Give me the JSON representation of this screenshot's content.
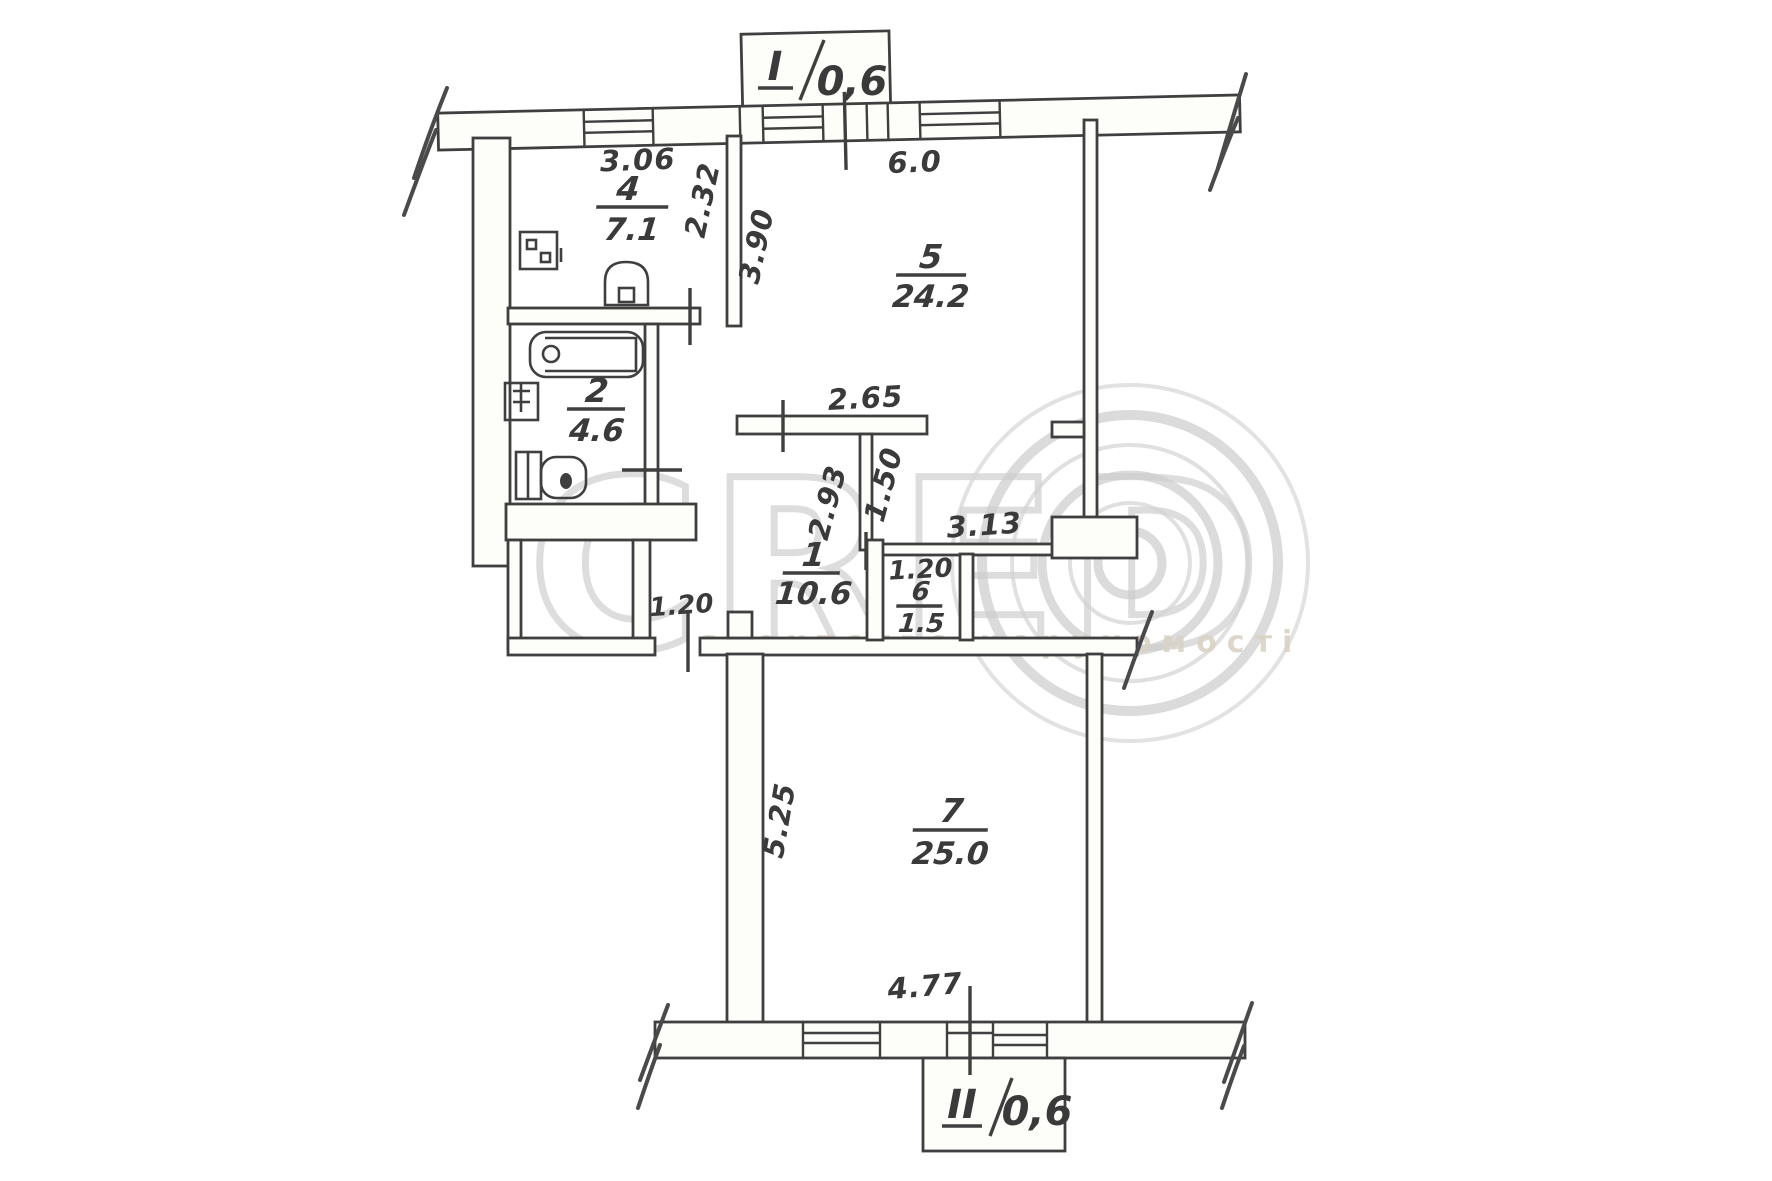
{
  "watermark": {
    "brand": "CRED",
    "agency": "агентство нерухомості"
  },
  "balconies": {
    "top": {
      "numeral": "I",
      "slash": "/",
      "area": "0,6"
    },
    "bottom": {
      "numeral": "II",
      "slash": "/",
      "area": "0,6"
    }
  },
  "rooms": [
    {
      "id": "kitchen",
      "number": "4",
      "area": "7.1"
    },
    {
      "id": "bathroom",
      "number": "2",
      "area": "4.6"
    },
    {
      "id": "living",
      "number": "5",
      "area": "24.2"
    },
    {
      "id": "hall",
      "number": "1",
      "area": "10.6"
    },
    {
      "id": "closet",
      "number": "6",
      "area": "1.5"
    },
    {
      "id": "bedroom",
      "number": "7",
      "area": "25.0"
    }
  ],
  "dimensions": {
    "kitchen_width": "3.06",
    "kitchen_depth": "2.32",
    "living_width": "6.0",
    "living_depth": "3.90",
    "hall_opening": "2.65",
    "hall_depth": "2.93",
    "niche_depth": "1.50",
    "partition_width": "3.13",
    "closet_width": "1.20",
    "door_width": "1.20",
    "bedroom_depth": "5.25",
    "bedroom_width": "4.77"
  },
  "colors": {
    "ink": "#3f3f3f",
    "watermark": "#d2d2d2",
    "paper": "#ffffff"
  }
}
